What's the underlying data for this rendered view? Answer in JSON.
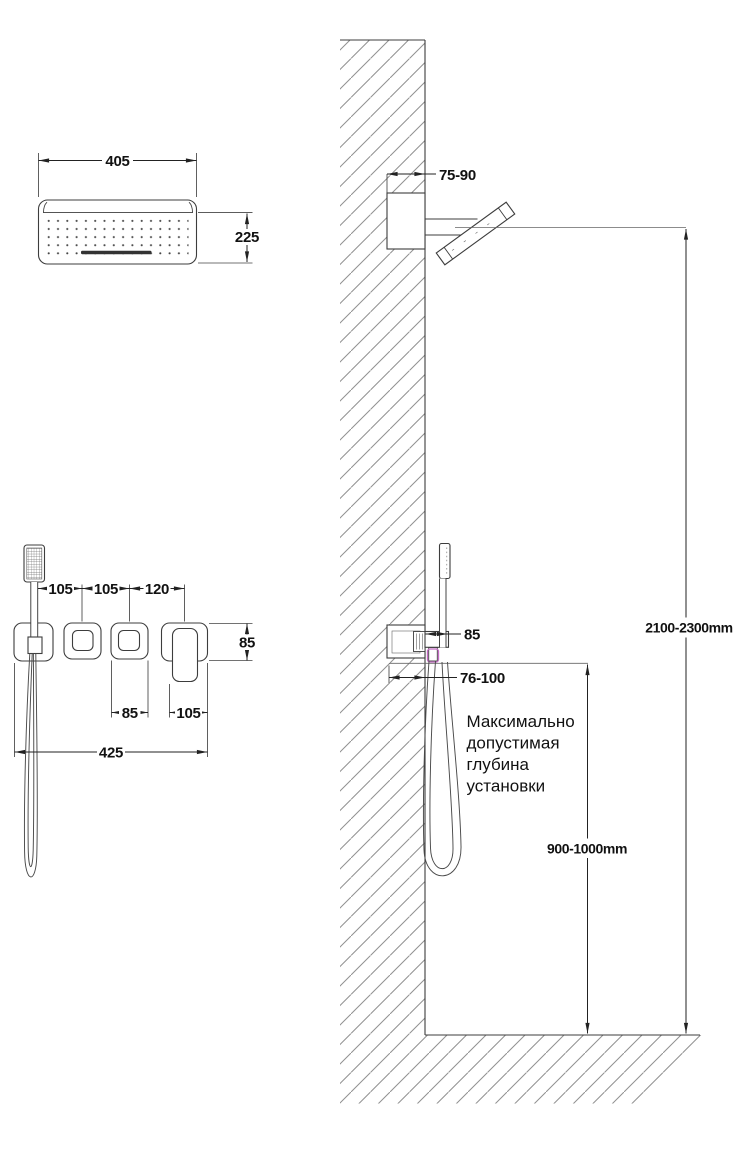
{
  "page": {
    "background": "#ffffff"
  },
  "colors": {
    "line": "#3d3d3d",
    "dimension": "#222222",
    "hatch": "#909090",
    "accent": "#c56cc5",
    "text": "#111111"
  },
  "top_view": {
    "width_label": "405",
    "height_label": "225"
  },
  "controls_view": {
    "spacing_1": "105",
    "spacing_2": "105",
    "spacing_3": "120",
    "plate_height": "85",
    "button_width": "85",
    "lever_plate_width": "105",
    "total_width": "425"
  },
  "section_view": {
    "head_depth": "75-90",
    "holder_width": "85",
    "mixer_depth": "76-100",
    "overall_height": "2100-2300mm",
    "mixer_height": "900-1000mm",
    "note": {
      "lines": [
        "Максимально",
        "допустимая",
        "глубина",
        "установки"
      ]
    }
  }
}
